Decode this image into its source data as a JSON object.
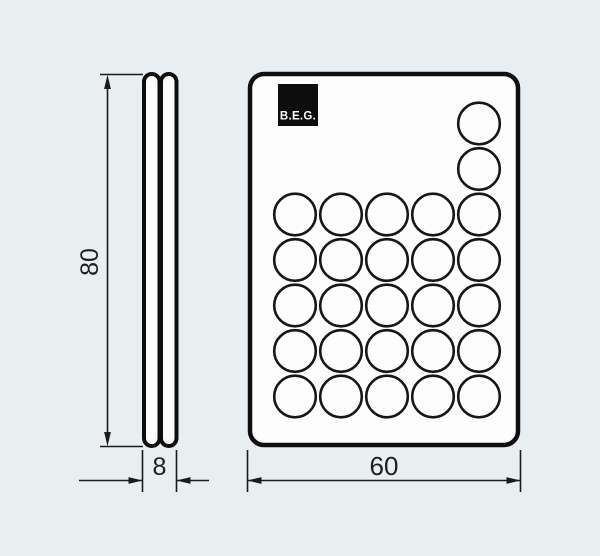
{
  "page": {
    "background_color": "#e9eef1",
    "line_color": "#1b1b1b",
    "body_fill": "#fdfdfd"
  },
  "drawing": {
    "type": "technical-dimension-drawing",
    "brand": {
      "label": "B.E.G.",
      "background": "#0d0d0d",
      "text_color": "#ffffff"
    },
    "dimensions": [
      {
        "id": "height",
        "label": "80",
        "orientation": "vertical",
        "applies_to": "side-view"
      },
      {
        "id": "thickness",
        "label": "8",
        "orientation": "horizontal",
        "applies_to": "side-view"
      },
      {
        "id": "width",
        "label": "60",
        "orientation": "horizontal",
        "applies_to": "front-view"
      }
    ],
    "side_view": {
      "description": "thin two-layer profile, rounded ends"
    },
    "front_view": {
      "button_count": 27,
      "button_rows": [
        {
          "row": 1,
          "columns": [
            5
          ]
        },
        {
          "row": 2,
          "columns": [
            5
          ]
        },
        {
          "row": 3,
          "columns": [
            1,
            2,
            3,
            4,
            5
          ]
        },
        {
          "row": 4,
          "columns": [
            1,
            2,
            3,
            4,
            5
          ]
        },
        {
          "row": 5,
          "columns": [
            1,
            2,
            3,
            4,
            5
          ]
        },
        {
          "row": 6,
          "columns": [
            1,
            2,
            3,
            4,
            5
          ]
        },
        {
          "row": 7,
          "columns": [
            1,
            2,
            3,
            4,
            5
          ]
        }
      ],
      "grid": {
        "col_start_x": 295,
        "col_step": 46,
        "row_start_y": 123.5,
        "row_step": 45.5,
        "radius": 20.8
      }
    }
  }
}
